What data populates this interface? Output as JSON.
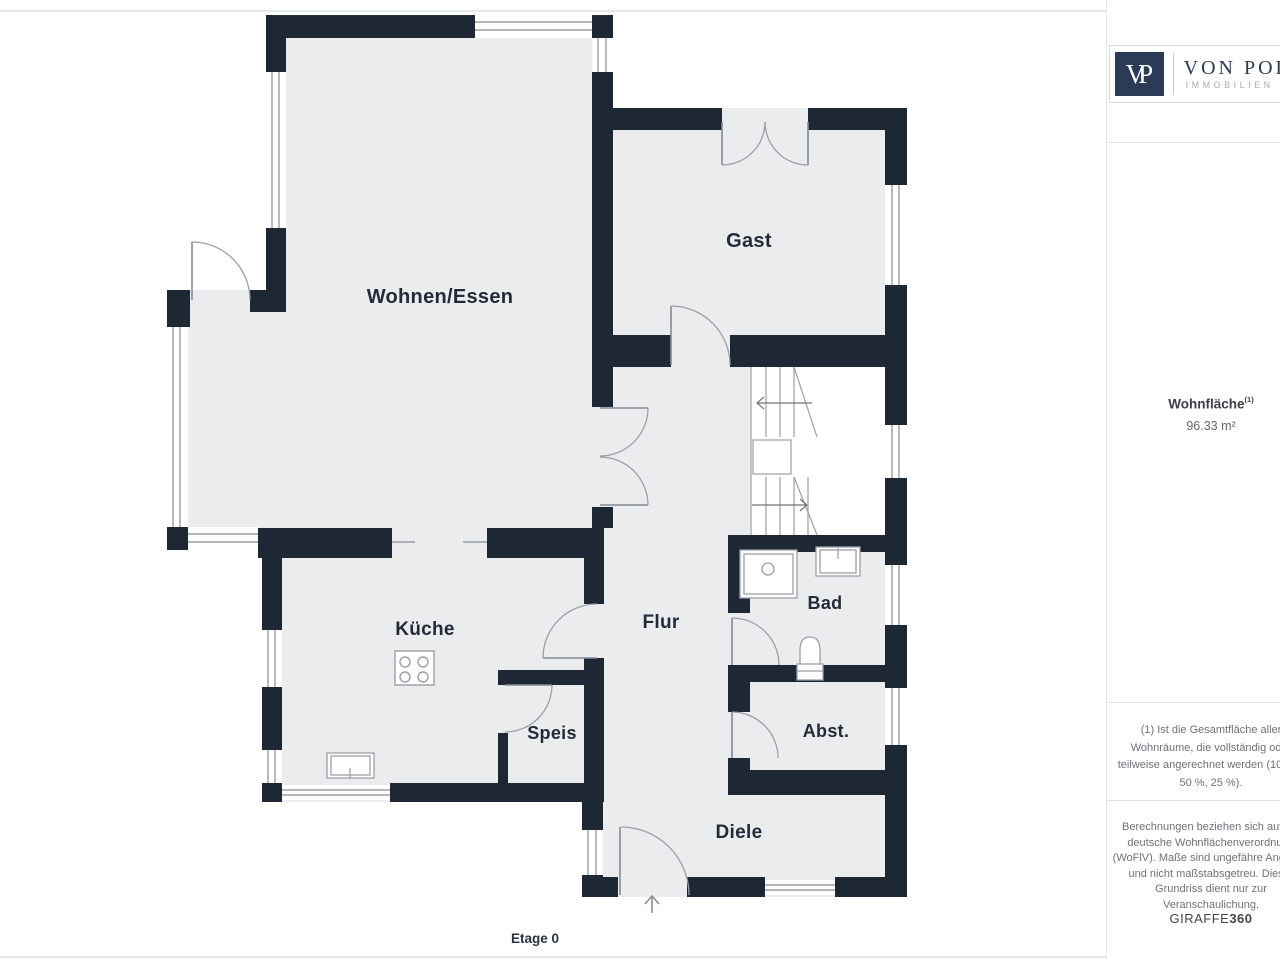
{
  "colors": {
    "wall": "#1d2834",
    "floor": "#ebecee",
    "line": "#9aa0a8",
    "leaf": "#848a93",
    "label": "#232b39",
    "logo_navy": "#2b3a55"
  },
  "plan": {
    "rooms": {
      "wohnen": "Wohnen/Essen",
      "gast": "Gast",
      "kueche": "Küche",
      "flur": "Flur",
      "bad": "Bad",
      "speis": "Speis",
      "abst": "Abst.",
      "diele": "Diele"
    },
    "floor_label": "Etage 0"
  },
  "sidebar": {
    "logo": {
      "monogram": "VP",
      "brand": "VON POLL",
      "subtitle": "IMMOBILIEN"
    },
    "area": {
      "label": "Wohnfläche",
      "sup": "(1)",
      "value": "96.33 m²"
    },
    "footnote": "(1) Ist die Gesamtfläche aller\nWohnräume, die vollständig oder\nteilweise angerechnet werden (100 %,\n50 %, 25 %).",
    "disclaimer": "Berechnungen beziehen sich auf die\ndeutsche Wohnflächenverordnung\n(WoFlV). Maße sind ungefähre Angaben\nund nicht maßstabsgetreu. Dieser\nGrundriss dient nur zur\nVeranschaulichung.",
    "brand_footer": {
      "name": "GIRAFFE",
      "suffix": "360"
    }
  }
}
